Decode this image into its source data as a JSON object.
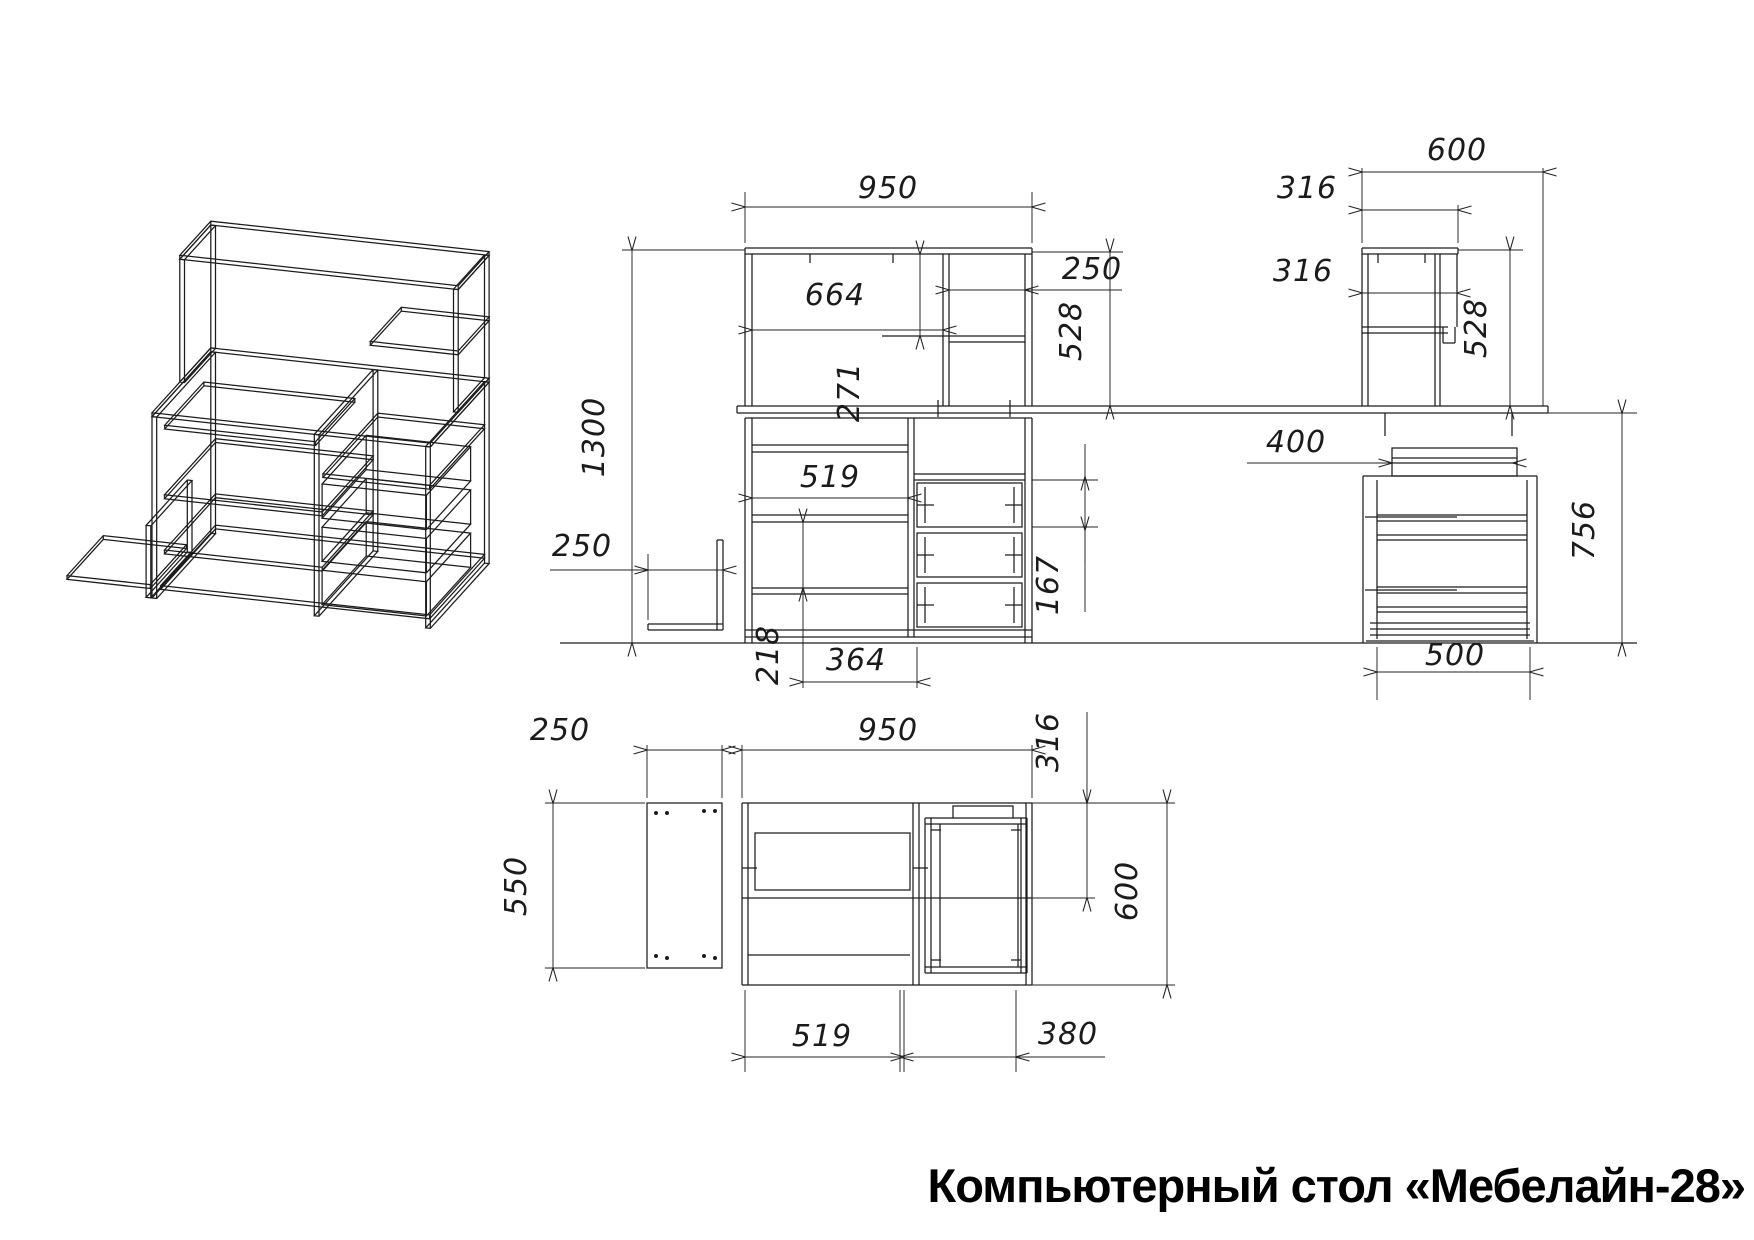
{
  "title": "Компьютерный стол «Мебелайн-28»",
  "drawing": {
    "kind": "furniture blueprint, three orthographic views + isometric wireframe",
    "line_color": "#1c1c1c",
    "background": "#ffffff",
    "views": {
      "isometric": {
        "name": "isometric view"
      },
      "front": {
        "name": "front view",
        "dims": {
          "total_width": "950",
          "hutch_opening_width": "664",
          "hutch_niche_width": "250",
          "hutch_height": "528",
          "hutch_shelf_drop": "271",
          "total_height": "1300",
          "side_shelf_width": "250",
          "desk_niche_width": "519",
          "lower_niche_height": "218",
          "bottom_span": "364",
          "drawer_pitch": "167"
        }
      },
      "side": {
        "name": "side view",
        "dims": {
          "desk_depth": "600",
          "top_shelf_depth": "316",
          "mid_shelf_depth": "316",
          "hutch_height": "528",
          "tray_depth": "400",
          "pedestal_height": "756",
          "drawer_depth": "500"
        }
      },
      "plan": {
        "name": "top view",
        "dims": {
          "side_panel_width": "250",
          "side_panel_depth": "550",
          "total_width": "950",
          "hutch_depth": "316",
          "desk_depth": "600",
          "tray_width": "519",
          "pedestal_width": "380"
        }
      }
    }
  }
}
